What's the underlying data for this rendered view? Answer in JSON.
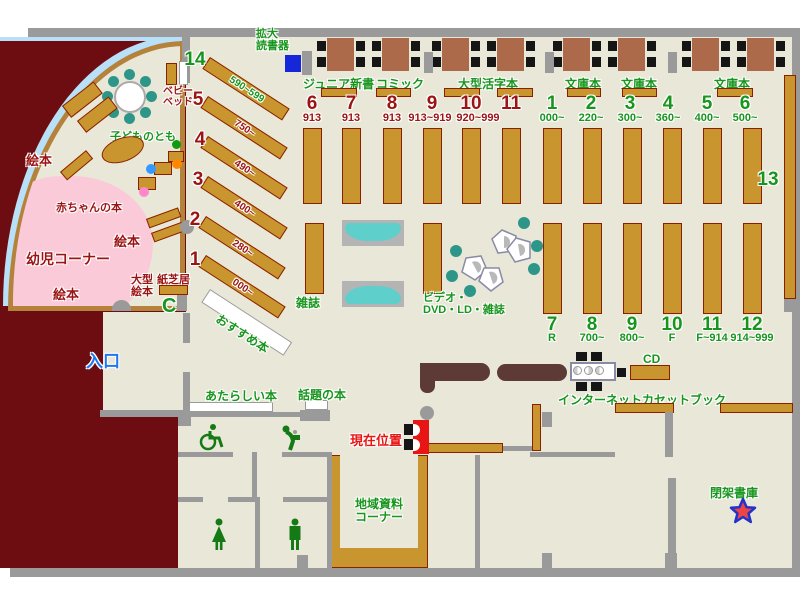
{
  "areas": {
    "entrance": "入口",
    "current_location": "現在位置",
    "magnifier": "拡大\n読書器",
    "baby_bed": "ベビー\nベッド",
    "kodomo_no_tomo": "子どものとも",
    "ehon": "絵本",
    "baby_books": "赤ちゃんの本",
    "toddler_corner": "幼児コーナー",
    "large_picture_books": "大型\n絵本",
    "kamishibai": "紙芝居",
    "recommended": "おすすめ本",
    "magazines": "雑誌",
    "av_corner": "ビデオ・\nDVD・LD・雑誌",
    "new_books": "あたらしい本",
    "topical_books": "話題の本",
    "local_materials": "地域資料\nコーナー",
    "internet": "インターネット",
    "cassette_books": "カセットブック",
    "cd": "CD",
    "closed_stacks": "閉架書庫"
  },
  "table_labels": {
    "junior": "ジュニア新書",
    "comic": "コミック",
    "large_print": "大型活字本",
    "bunko": "文庫本"
  },
  "sections": {
    "diagonal": [
      {
        "no": "14",
        "range": "590~599"
      },
      {
        "no": "5",
        "range": "750~"
      },
      {
        "no": "4",
        "range": "490~"
      },
      {
        "no": "3",
        "range": "400~"
      },
      {
        "no": "2",
        "range": "280~"
      },
      {
        "no": "1",
        "range": "000~"
      }
    ],
    "top_red": [
      {
        "no": "6",
        "range": "913"
      },
      {
        "no": "7",
        "range": "913"
      },
      {
        "no": "8",
        "range": "913"
      },
      {
        "no": "9",
        "range": "913~919"
      },
      {
        "no": "10",
        "range": "920~999"
      },
      {
        "no": "11",
        "range": ""
      }
    ],
    "top_green": [
      {
        "no": "1",
        "range": "000~"
      },
      {
        "no": "2",
        "range": "220~"
      },
      {
        "no": "3",
        "range": "300~"
      },
      {
        "no": "4",
        "range": "360~"
      },
      {
        "no": "5",
        "range": "400~"
      },
      {
        "no": "6",
        "range": "500~"
      }
    ],
    "bottom_green": [
      {
        "no": "7",
        "range": "R"
      },
      {
        "no": "8",
        "range": "700~"
      },
      {
        "no": "9",
        "range": "800~"
      },
      {
        "no": "10",
        "range": "F"
      },
      {
        "no": "11",
        "range": "F~914"
      },
      {
        "no": "12",
        "range": "914~999"
      }
    ],
    "shelf13": "13"
  },
  "colors": {
    "floor": "#e9e8d8",
    "wall": "#9a9a9a",
    "outside": "#6e0d11",
    "shelf": "#c9952f",
    "shelfb": "#8b2000",
    "table": "#ad6a4a",
    "chair": "#151515",
    "teal": "#2e9688",
    "sofa": "#5ecfca",
    "pink": "#fbcad9",
    "green": "#18951d",
    "dred": "#9b1414",
    "red": "#e81515",
    "blue": "#2277f0",
    "counter": "#5d3a36",
    "lblue": "#b8e0f8",
    "bluesq": "#1527d8",
    "starred": "#ee4444",
    "starblue": "#2233cc"
  }
}
